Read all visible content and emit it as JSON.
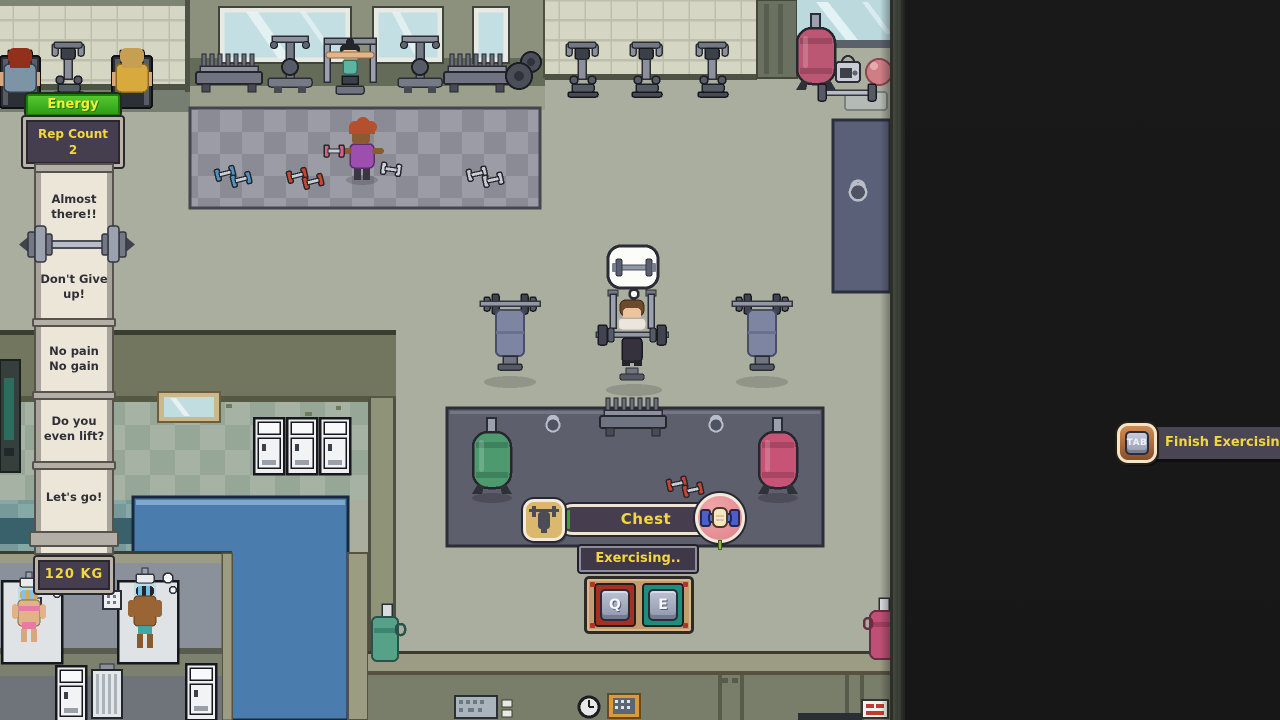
{
  "hud": {
    "energy": {
      "label": "Energy"
    },
    "rep_counter": {
      "title": "Rep Count",
      "value": "2"
    },
    "banner": {
      "quotes": [
        "Almost\nthere!!",
        "Don't Give\nup!",
        "No pain\nNo gain",
        "Do you\neven lift?",
        "Let's go!"
      ]
    },
    "weight": {
      "label": "120 KG"
    },
    "exercise": {
      "name": "Chest",
      "status": "Exercising..",
      "key_left": "Q",
      "key_right": "E"
    },
    "finish": {
      "key": "TAB",
      "label": "Finish Exercising"
    }
  },
  "icons": {
    "thought_bubble": "barbell-icon",
    "progress_left": "bench-press-icon",
    "progress_right": "fist-dumbbell-icon"
  },
  "colors": {
    "accent_yellow": "#f2d73e",
    "energy_green": "#3fb823",
    "panel_dark": "#453e4e",
    "progress_green": "#3fa32f",
    "key_red": "#a82d23",
    "key_teal": "#1f8d7e",
    "tab_orange": "#b06a3a",
    "banner_paper": "#ece6d9"
  }
}
